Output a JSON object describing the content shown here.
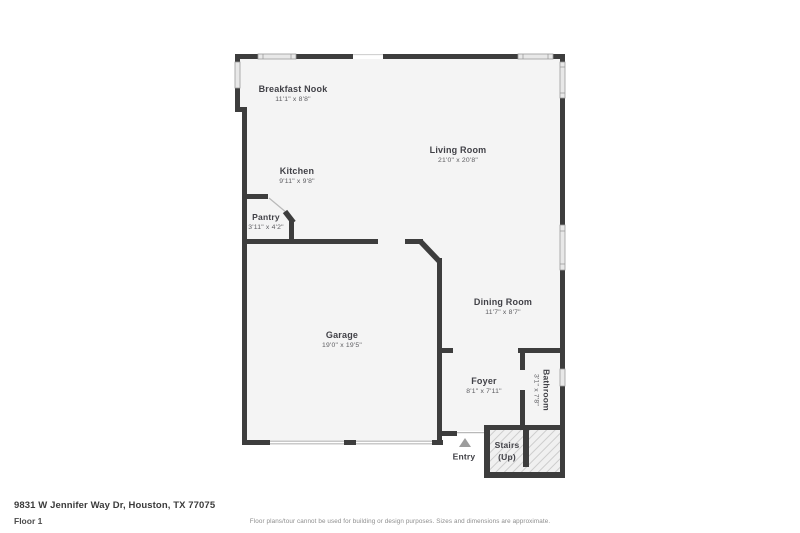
{
  "floor_plan": {
    "rooms": [
      {
        "id": "breakfast-nook",
        "name": "Breakfast Nook",
        "dims": "11'1\" x 8'8\""
      },
      {
        "id": "living-room",
        "name": "Living Room",
        "dims": "21'0\" x 20'8\""
      },
      {
        "id": "kitchen",
        "name": "Kitchen",
        "dims": "9'11\" x 9'8\""
      },
      {
        "id": "pantry",
        "name": "Pantry",
        "dims": "3'11\" x 4'2\""
      },
      {
        "id": "garage",
        "name": "Garage",
        "dims": "19'0\" x 19'5\""
      },
      {
        "id": "dining-room",
        "name": "Dining Room",
        "dims": "11'7\" x 8'7\""
      },
      {
        "id": "foyer",
        "name": "Foyer",
        "dims": "8'1\" x 7'11\""
      },
      {
        "id": "bathroom",
        "name": "Bathroom",
        "dims": "3'1\" x 7'8\""
      },
      {
        "id": "stairs",
        "name": "Stairs",
        "dims": "(Up)"
      }
    ],
    "entry_label": "Entry"
  },
  "footer": {
    "address": "9831 W Jennifer Way Dr, Houston, TX 77075",
    "floor_label": "Floor 1",
    "disclaimer": "Floor plans/tour cannot be used for building or design purposes. Sizes and dimensions are approximate."
  },
  "colors": {
    "wall": "#3d3d3d",
    "room_fill": "#f4f4f4",
    "window_fill": "#e8e8e8",
    "window_frame": "#9b9b9b",
    "hatch_stripe": "#cccccc",
    "entry_arrow": "#9c9c9c",
    "title_text": "#414147",
    "dims_text": "#5c5c60"
  }
}
